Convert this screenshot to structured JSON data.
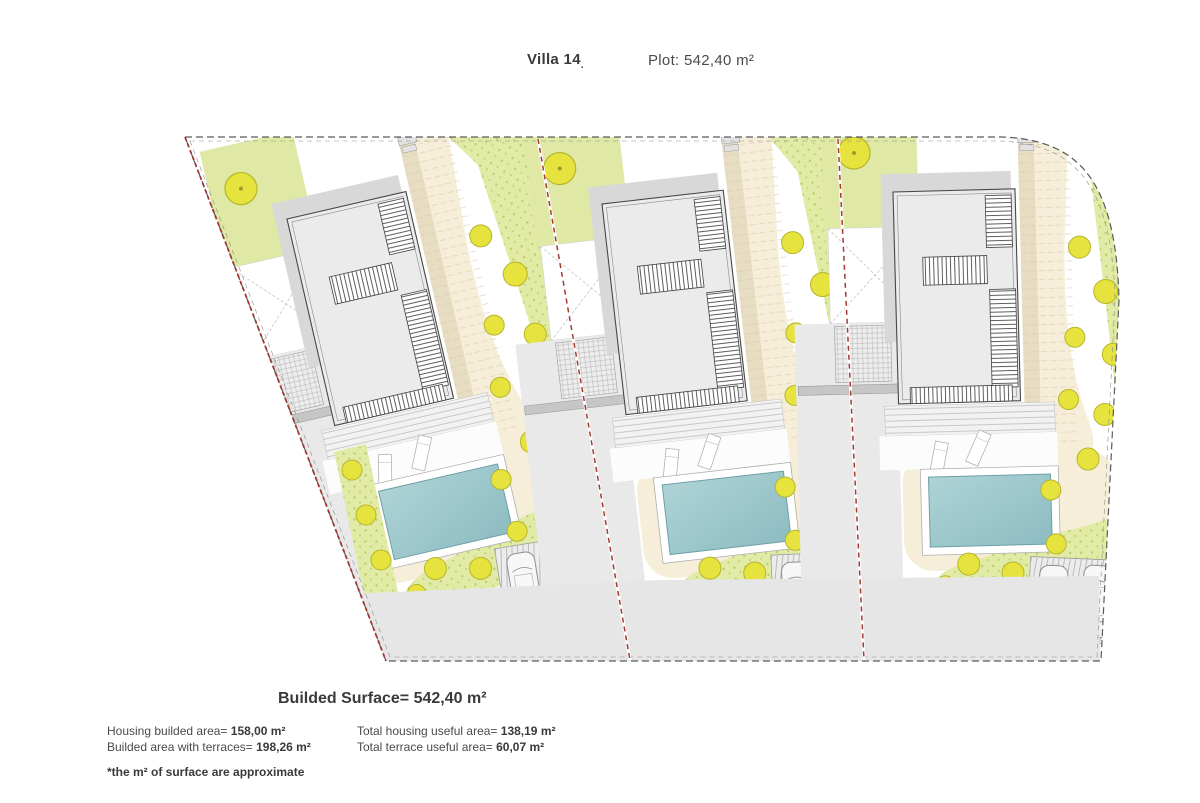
{
  "header": {
    "villa_label": "Villa 14",
    "villa_label_mark": ".",
    "plot_label": "Plot: 542,40 m²"
  },
  "summary": {
    "built_surface_label": "Builded Surface=",
    "built_surface_value": "542,40 m²",
    "stats_left": [
      {
        "label": "Housing builded area=",
        "value": "158,00 m²"
      },
      {
        "label": "Builded area with terraces=",
        "value": "198,26 m²"
      }
    ],
    "stats_right": [
      {
        "label": "Total housing useful area=",
        "value": "138,19 m²"
      },
      {
        "label": "Total terrace useful area=",
        "value": "60,07 m²"
      }
    ],
    "footnote": "*the m² of surface are approximate"
  },
  "watermark": {
    "text": "nk"
  },
  "site_plan": {
    "units_count": 3,
    "unit_names": [
      "villa-unit-1",
      "villa-unit-2",
      "villa-unit-3"
    ],
    "features_per_unit": [
      "building",
      "roof-stair-hatches",
      "deck-terrace",
      "sun-loungers",
      "pool",
      "garden",
      "driveway",
      "parking-pad-2-cars",
      "tree",
      "bushes"
    ],
    "colors": {
      "garden": "#dfe8a4",
      "slope": "#e2eba6",
      "beige": "#f6eed8",
      "beige_dark": "#e3d8bd",
      "road": "#e6e6e6",
      "gray_drive": "#e9e9e9",
      "building": "#ebebeb",
      "building_shadow": "#d8d8d8",
      "pool_water": "#9ac7cc",
      "boundary_red": "#a23a34",
      "tree_fill": "#e6e33e",
      "tree_stroke": "#b5b52a"
    }
  }
}
